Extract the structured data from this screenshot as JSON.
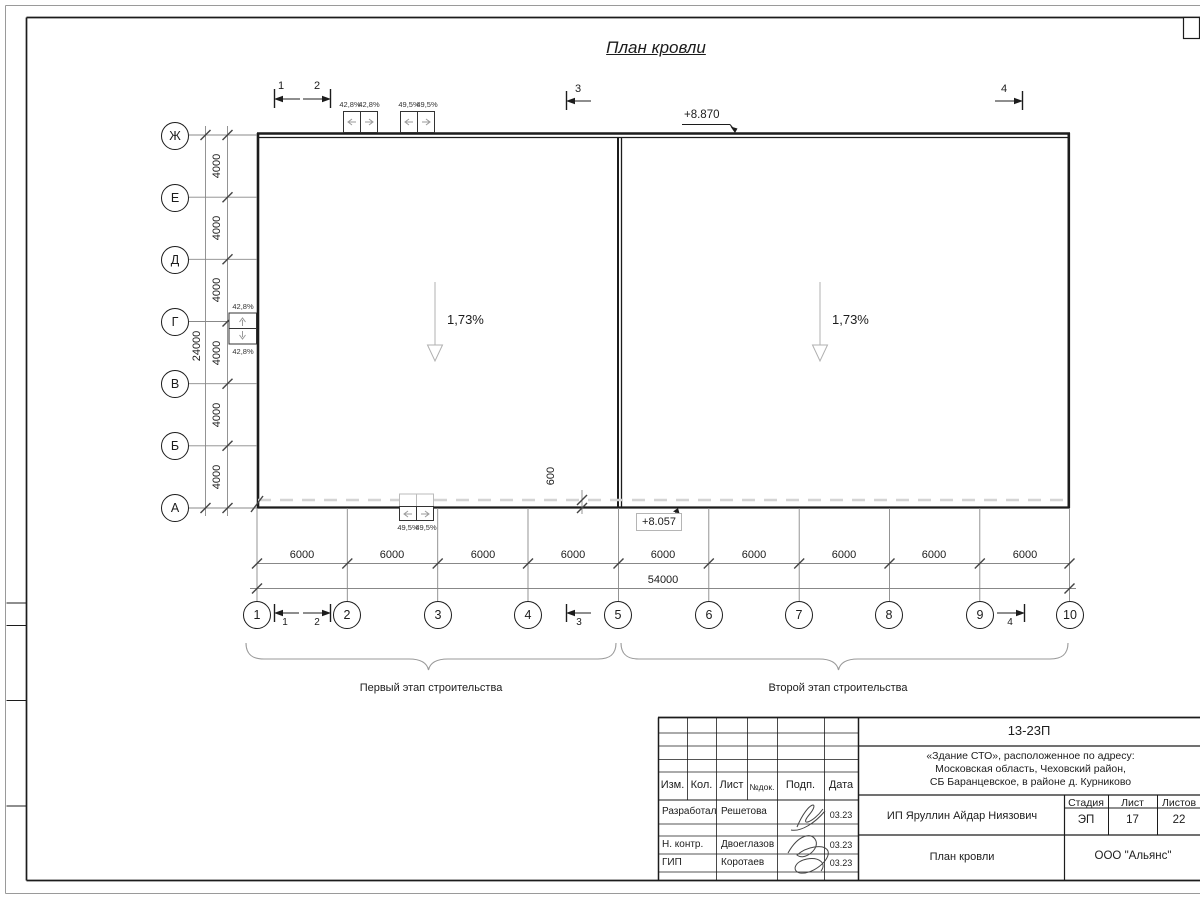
{
  "sheet": {
    "title": "План кровли",
    "elevation_top": "+8.870",
    "elevation_bottom": "+8.057",
    "slope_left": "1,73%",
    "slope_right": "1,73%",
    "stage_left": "Первый этап строительства",
    "stage_right": "Второй этап строительства",
    "section_marks": {
      "m1": "1",
      "m2": "2",
      "m3": "3",
      "m4": "4"
    }
  },
  "funnels": {
    "top_pair1": [
      "42,8%",
      "42,8%"
    ],
    "top_pair2": [
      "49,5%",
      "49,5%"
    ],
    "bottom_pair": [
      "49,5%",
      "49,5%"
    ],
    "side_pair": [
      "42,8%",
      "42,8%"
    ]
  },
  "grid": {
    "rows": [
      "Ж",
      "Е",
      "Д",
      "Г",
      "В",
      "Б",
      "А"
    ],
    "row_spacing": [
      "4000",
      "4000",
      "4000",
      "4000",
      "4000",
      "4000"
    ],
    "row_total": "24000",
    "cols": [
      "1",
      "2",
      "3",
      "4",
      "5",
      "6",
      "7",
      "8",
      "9",
      "10"
    ],
    "col_spacing": [
      "6000",
      "6000",
      "6000",
      "6000",
      "6000",
      "6000",
      "6000",
      "6000",
      "6000"
    ],
    "col_total": "54000",
    "parapet_dim": "600"
  },
  "titleblock": {
    "doc_number": "13-23П",
    "object_line1": "«Здание СТО», расположенное по адресу:",
    "object_line2": "Московская область, Чеховский район,",
    "object_line3": "СБ Баранцевское, в районе д. Курниково",
    "client": "ИП Яруллин Айдар Ниязович",
    "sheet_name": "План кровли",
    "company": "ООО \"Альянс\"",
    "stage_label": "Стадия",
    "stage": "ЭП",
    "sheet_label": "Лист",
    "sheet_no": "17",
    "sheets_label": "Листов",
    "sheets_total": "22",
    "header": {
      "izm": "Изм.",
      "kol": "Кол.",
      "list": "Лист",
      "doc": "№док.",
      "podp": "Подп.",
      "data": "Дата"
    },
    "roles": [
      {
        "role": "Разработал",
        "name": "Решетова",
        "date": "03.23"
      },
      {
        "role": "Н. контр.",
        "name": "Двоеглазов",
        "date": "03.23"
      },
      {
        "role": "ГИП",
        "name": "Коротаев",
        "date": "03.23"
      }
    ]
  }
}
